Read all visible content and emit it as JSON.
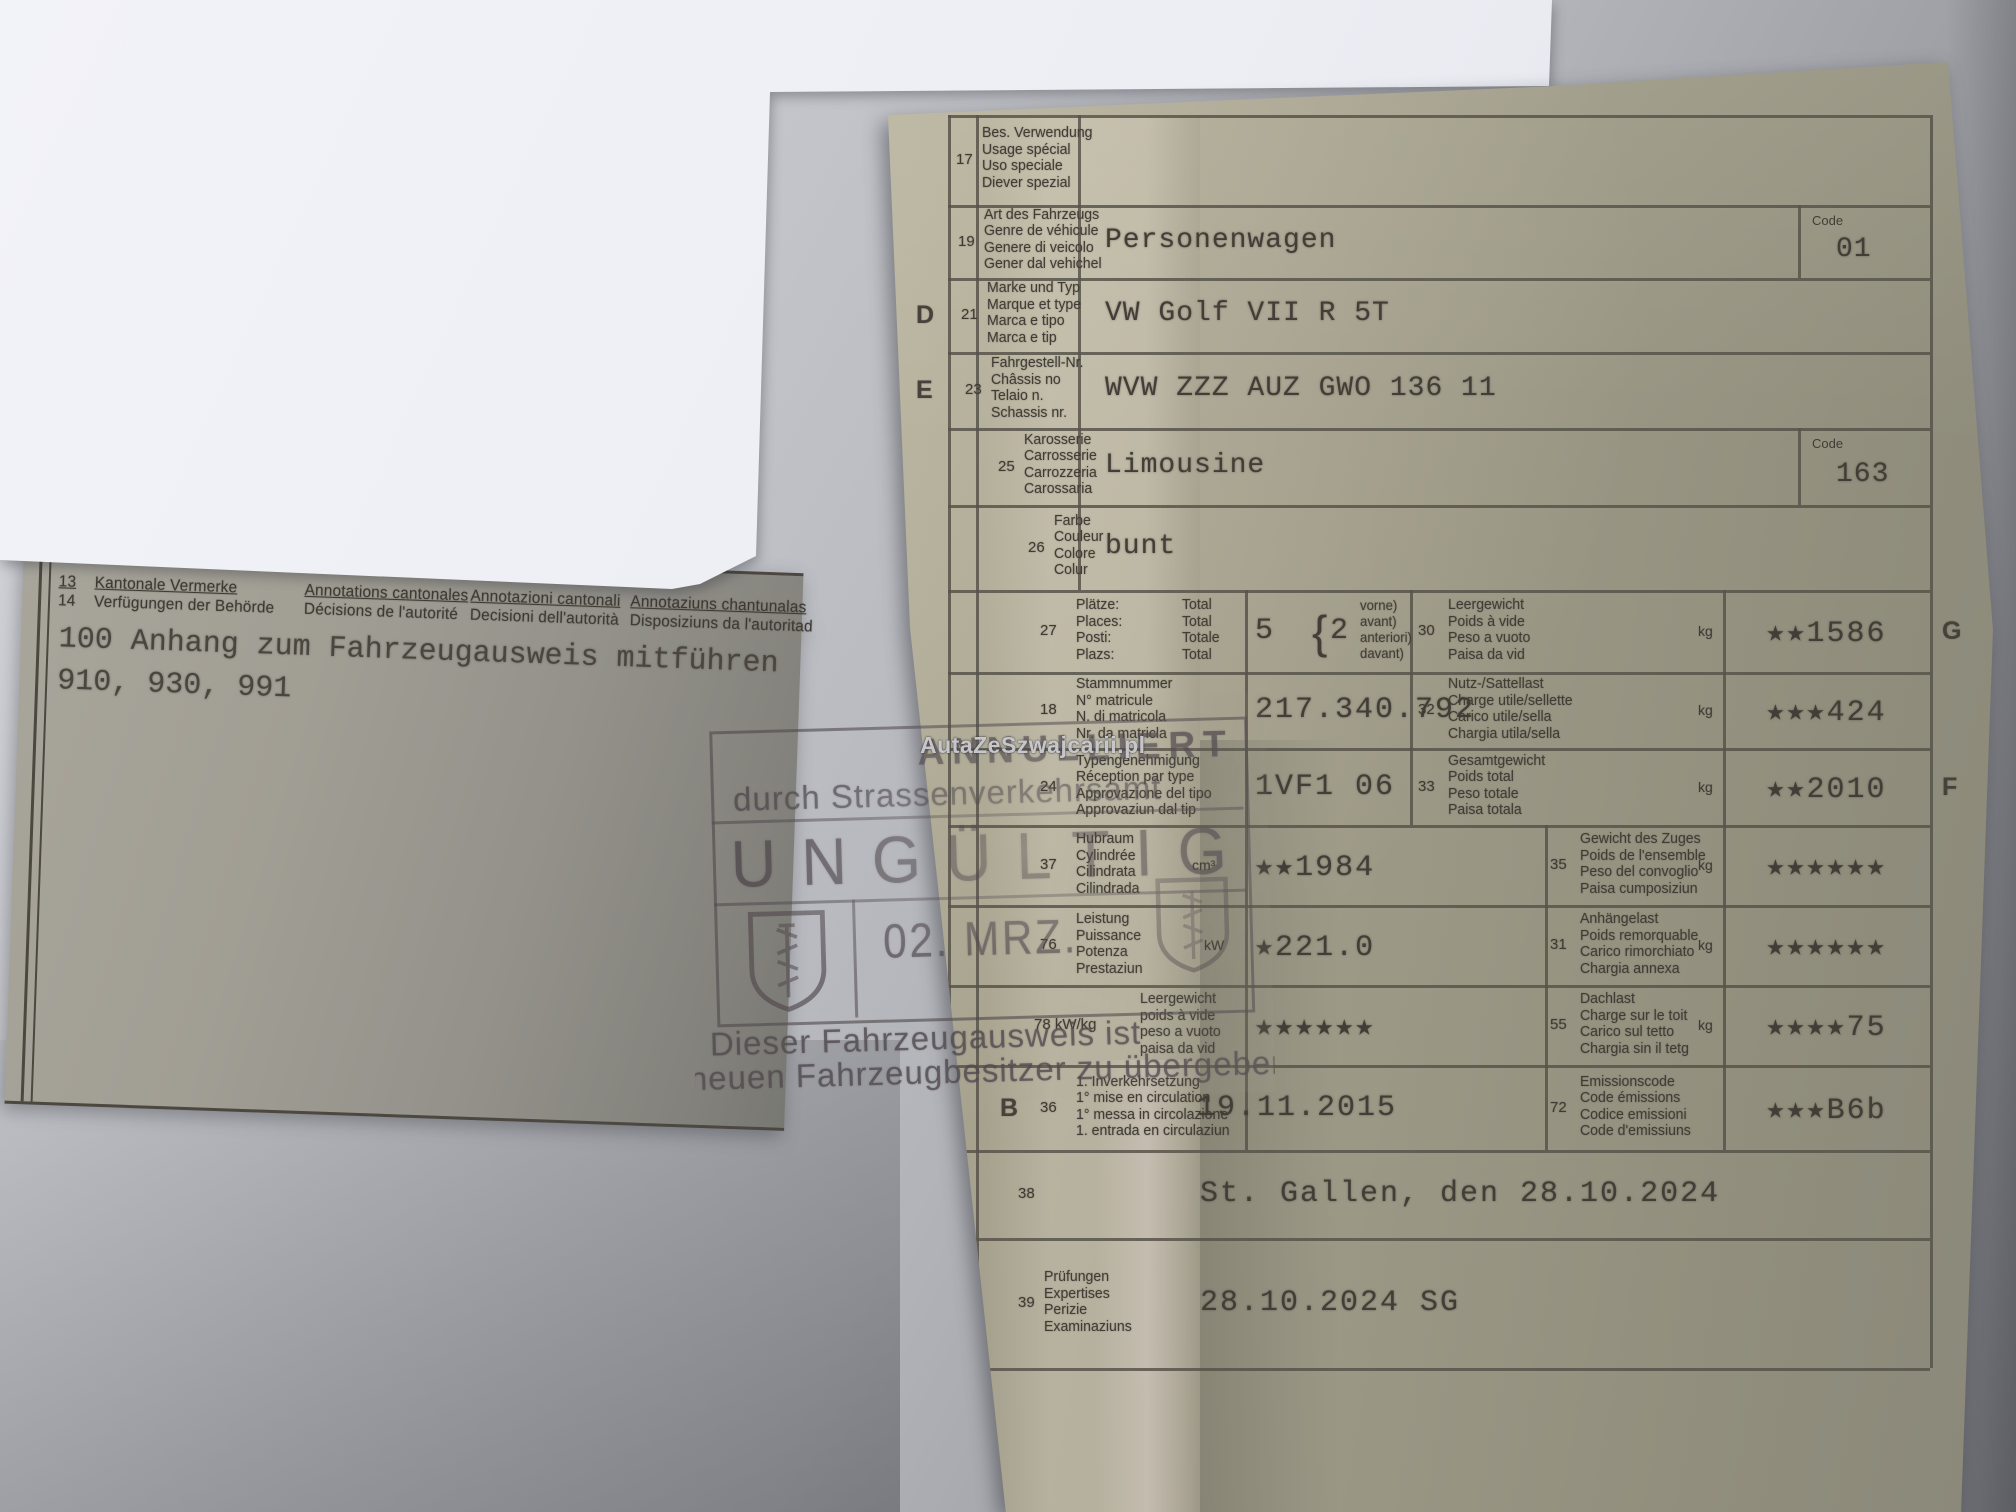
{
  "watermark": "AutaZeSzwajcarii.pl",
  "left_doc": {
    "row13_num": "13",
    "row14_num": "14",
    "header_de": [
      "Kantonale Vermerke",
      "Verfügungen der Behörde"
    ],
    "header_fr": [
      "Annotations cantonales",
      "Décisions de l'autorité"
    ],
    "header_it": [
      "Annotazioni cantonali",
      "Decisioni dell'autorità"
    ],
    "header_rm": [
      "Annotaziuns chantunalas",
      "Disposiziuns da l'autoritad"
    ],
    "typed_line1": "100 Anhang zum Fahrzeugausweis mitführen",
    "typed_line2": "910, 930, 991"
  },
  "stamp": {
    "line1": "ANNULLIERT",
    "line2": "durch Strassenverkehrsamt",
    "invalid": "UNGÜLTIG",
    "date": "02. MRZ.",
    "footer1": "Dieser Fahrzeugausweis ist",
    "footer2": "neuen Fahrzeugbesitzer zu übergeben"
  },
  "right_doc": {
    "code_header": "Code",
    "top_rows": [
      {
        "num": "17",
        "labels": [
          "Bes. Verwendung",
          "Usage spécial",
          "Uso speciale",
          "Diever spezial"
        ],
        "value": ""
      },
      {
        "num": "19",
        "labels": [
          "Art des Fahrzeugs",
          "Genre de véhicule",
          "Genere di veicolo",
          "Gener dal vehichel"
        ],
        "value": "Personenwagen",
        "code": "01"
      },
      {
        "num": "21",
        "letter": "D",
        "labels": [
          "Marke und Typ",
          "Marque et type",
          "Marca e tipo",
          "Marca e tip"
        ],
        "value": "VW Golf VII R 5T"
      },
      {
        "num": "23",
        "letter": "E",
        "labels": [
          "Fahrgestell-Nr.",
          "Châssis no",
          "Telaio n.",
          "Schassis nr."
        ],
        "value": "WVW ZZZ AUZ GWO 136 11"
      },
      {
        "num": "25",
        "labels": [
          "Karosserie",
          "Carrosserie",
          "Carrozzeria",
          "Carossaria"
        ],
        "value": "Limousine",
        "code": "163"
      },
      {
        "num": "26",
        "labels": [
          "Farbe",
          "Couleur",
          "Colore",
          "Colur"
        ],
        "value": "bunt"
      }
    ],
    "mid_rows": [
      {
        "left": {
          "num": "27",
          "labels": [
            "Plätze:",
            "Places:",
            "Posti:",
            "Plazs:"
          ],
          "totals": [
            "Total",
            "Total",
            "Totale",
            "Total"
          ],
          "value": "5",
          "value2": "2",
          "parens": [
            "vorne)",
            "avant)",
            "anteriori)",
            "davant)"
          ]
        },
        "right": {
          "num": "30",
          "labels": [
            "Leergewicht",
            "Poids à vide",
            "Peso a vuoto",
            "Paisa da vid"
          ],
          "unit": "kg",
          "value": "★★1586",
          "letter": "G"
        }
      },
      {
        "left": {
          "num": "18",
          "labels": [
            "Stammnummer",
            "N° matricule",
            "N. di matricola",
            "Nr. da matricla"
          ],
          "value": "217.340.792"
        },
        "right": {
          "num": "32",
          "labels": [
            "Nutz-/Sattellast",
            "Charge utile/sellette",
            "Carico utile/sella",
            "Chargia utila/sella"
          ],
          "unit": "kg",
          "value": "★★★424"
        }
      },
      {
        "left": {
          "num": "24",
          "labels": [
            "Typengenehmigung",
            "Réception par type",
            "Approvazione del tipo",
            "Approvaziun dal tip"
          ],
          "value": "1VF1 06"
        },
        "right": {
          "num": "33",
          "labels": [
            "Gesamtgewicht",
            "Poids total",
            "Peso totale",
            "Paisa totala"
          ],
          "unit": "kg",
          "value": "★★2010",
          "letter": "F"
        }
      },
      {
        "left": {
          "num": "37",
          "labels": [
            "Hubraum",
            "Cylindrée",
            "Cilindrata",
            "Cilindrada"
          ],
          "unit": "cm³",
          "value": "★★1984"
        },
        "right": {
          "num": "35",
          "labels": [
            "Gewicht des Zuges",
            "Poids de l'ensemble",
            "Peso del convoglio",
            "Paisa cumposiziun"
          ],
          "unit": "kg",
          "value": "★★★★★★"
        }
      },
      {
        "left": {
          "num": "76",
          "labels": [
            "Leistung",
            "Puissance",
            "Potenza",
            "Prestaziun"
          ],
          "unit": "kW",
          "value": "★221.0"
        },
        "right": {
          "num": "31",
          "labels": [
            "Anhängelast",
            "Poids remorquable",
            "Carico rimorchiato",
            "Chargia annexa"
          ],
          "unit": "kg",
          "value": "★★★★★★"
        }
      },
      {
        "left": {
          "num": "78 kW/kg",
          "labels": [
            "Leergewicht",
            "poids à vide",
            "peso a vuoto",
            "paisa da vid"
          ],
          "value": "★★★★★★"
        },
        "right": {
          "num": "55",
          "labels": [
            "Dachlast",
            "Charge sur le toit",
            "Carico sul tetto",
            "Chargia sin il tetg"
          ],
          "unit": "kg",
          "value": "★★★★75"
        }
      },
      {
        "left": {
          "num": "36",
          "letter": "B",
          "labels": [
            "1. Inverkehrsetzung",
            "1° mise en circulation",
            "1° messa in circolazione",
            "1. entrada en circulaziun"
          ],
          "value": "19.11.2015"
        },
        "right": {
          "num": "72",
          "labels": [
            "Emissionscode",
            "Code émissions",
            "Codice emissioni",
            "Code d'emissiuns"
          ],
          "value": "★★★B6b"
        }
      }
    ],
    "bottom_rows": [
      {
        "num": "38",
        "labels": [],
        "value": "St. Gallen, den 28.10.2024"
      },
      {
        "num": "39",
        "labels": [
          "Prüfungen",
          "Expertises",
          "Perizie",
          "Examinaziuns"
        ],
        "value": "28.10.2024 SG"
      }
    ]
  }
}
